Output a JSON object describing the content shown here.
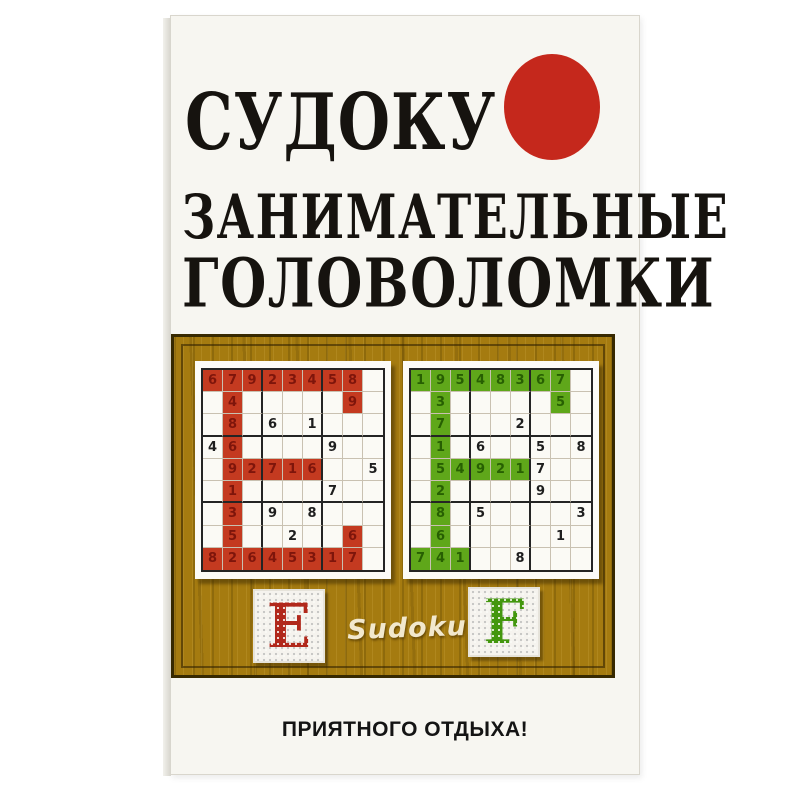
{
  "cover": {
    "title_line1": "СУДОКУ",
    "title_line2": "ЗАНИМАТЕЛЬНЫЕ",
    "title_line3": "ГОЛОВОЛОМКИ",
    "sudoku_label": "Sudoku",
    "tagline": "ПРИЯТНОГО ОТДЫХА!",
    "accent_red_circle": "#c5281c",
    "wood_color": "#a57b10"
  },
  "grids": [
    {
      "name": "letter-E-sudoku",
      "highlight_color": "#c43a20",
      "highlight_digit_color": "#7e150b",
      "values": [
        [
          "6",
          "7",
          "9",
          "2",
          "3",
          "4",
          "5",
          "8",
          ""
        ],
        [
          "",
          "4",
          "",
          "",
          "",
          "",
          "",
          "9",
          ""
        ],
        [
          "",
          "8",
          "",
          "6",
          "",
          "1",
          "",
          "",
          ""
        ],
        [
          "4",
          "6",
          "",
          "",
          "",
          "",
          "9",
          "",
          ""
        ],
        [
          "",
          "9",
          "2",
          "7",
          "1",
          "6",
          "",
          "",
          "5"
        ],
        [
          "",
          "1",
          "",
          "",
          "",
          "",
          "7",
          "",
          ""
        ],
        [
          "",
          "3",
          "",
          "9",
          "",
          "8",
          "",
          "",
          ""
        ],
        [
          "",
          "5",
          "",
          "",
          "2",
          "",
          "",
          "6",
          ""
        ],
        [
          "8",
          "2",
          "6",
          "4",
          "5",
          "3",
          "1",
          "7",
          ""
        ]
      ],
      "highlight": [
        [
          1,
          1,
          1,
          1,
          1,
          1,
          1,
          1,
          0
        ],
        [
          0,
          1,
          0,
          0,
          0,
          0,
          0,
          1,
          0
        ],
        [
          0,
          1,
          0,
          0,
          0,
          0,
          0,
          0,
          0
        ],
        [
          0,
          1,
          0,
          0,
          0,
          0,
          0,
          0,
          0
        ],
        [
          0,
          1,
          1,
          1,
          1,
          1,
          0,
          0,
          0
        ],
        [
          0,
          1,
          0,
          0,
          0,
          0,
          0,
          0,
          0
        ],
        [
          0,
          1,
          0,
          0,
          0,
          0,
          0,
          0,
          0
        ],
        [
          0,
          1,
          0,
          0,
          0,
          0,
          0,
          1,
          0
        ],
        [
          1,
          1,
          1,
          1,
          1,
          1,
          1,
          1,
          0
        ]
      ]
    },
    {
      "name": "letter-F-sudoku",
      "highlight_color": "#5fa71a",
      "highlight_digit_color": "#275f02",
      "values": [
        [
          "1",
          "9",
          "5",
          "4",
          "8",
          "3",
          "6",
          "7",
          ""
        ],
        [
          "",
          "3",
          "",
          "",
          "",
          "",
          "",
          "5",
          ""
        ],
        [
          "",
          "7",
          "",
          "",
          "",
          "2",
          "",
          "",
          ""
        ],
        [
          "",
          "1",
          "",
          "6",
          "",
          "",
          "5",
          "",
          "8"
        ],
        [
          "",
          "5",
          "4",
          "9",
          "2",
          "1",
          "7",
          "",
          ""
        ],
        [
          "",
          "2",
          "",
          "",
          "",
          "",
          "9",
          "",
          ""
        ],
        [
          "",
          "8",
          "",
          "5",
          "",
          "",
          "",
          "",
          "3"
        ],
        [
          "",
          "6",
          "",
          "",
          "",
          "",
          "",
          "1",
          ""
        ],
        [
          "7",
          "4",
          "1",
          "",
          "",
          "8",
          "",
          "",
          ""
        ]
      ],
      "highlight": [
        [
          1,
          1,
          1,
          1,
          1,
          1,
          1,
          1,
          0
        ],
        [
          0,
          1,
          0,
          0,
          0,
          0,
          0,
          1,
          0
        ],
        [
          0,
          1,
          0,
          0,
          0,
          0,
          0,
          0,
          0
        ],
        [
          0,
          1,
          0,
          0,
          0,
          0,
          0,
          0,
          0
        ],
        [
          0,
          1,
          1,
          1,
          1,
          1,
          0,
          0,
          0
        ],
        [
          0,
          1,
          0,
          0,
          0,
          0,
          0,
          0,
          0
        ],
        [
          0,
          1,
          0,
          0,
          0,
          0,
          0,
          0,
          0
        ],
        [
          0,
          1,
          0,
          0,
          0,
          0,
          0,
          0,
          0
        ],
        [
          1,
          1,
          1,
          0,
          0,
          0,
          0,
          0,
          0
        ]
      ]
    }
  ],
  "tiles": [
    {
      "letter": "E",
      "color": "#b1281b"
    },
    {
      "letter": "F",
      "color": "#43970e"
    }
  ]
}
